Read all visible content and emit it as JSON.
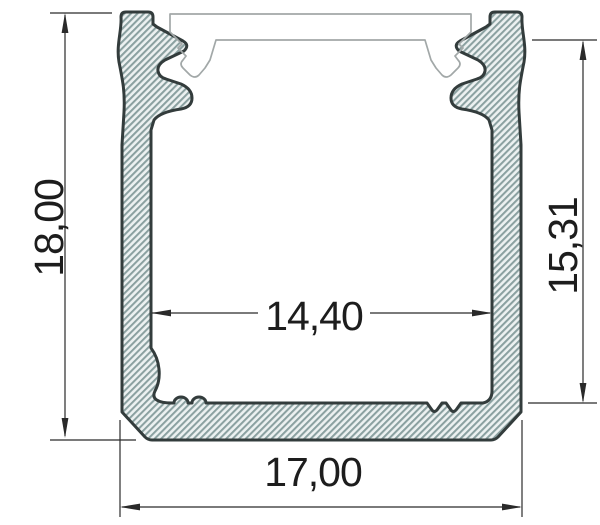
{
  "drawing": {
    "dimensions": {
      "overall_height": "18,00",
      "inner_height": "15,31",
      "inner_width": "14,40",
      "overall_width": "17,00"
    },
    "colors": {
      "profile_outline": "#333c3c",
      "hatch_line": "#8aa0a0",
      "hatch_background": "#ecf1f1",
      "cover_outline": "#a2a8a8",
      "dimension_lines": "#2a2a2a",
      "dimension_text": "#1d1d1d",
      "background": "#ffffff"
    }
  }
}
